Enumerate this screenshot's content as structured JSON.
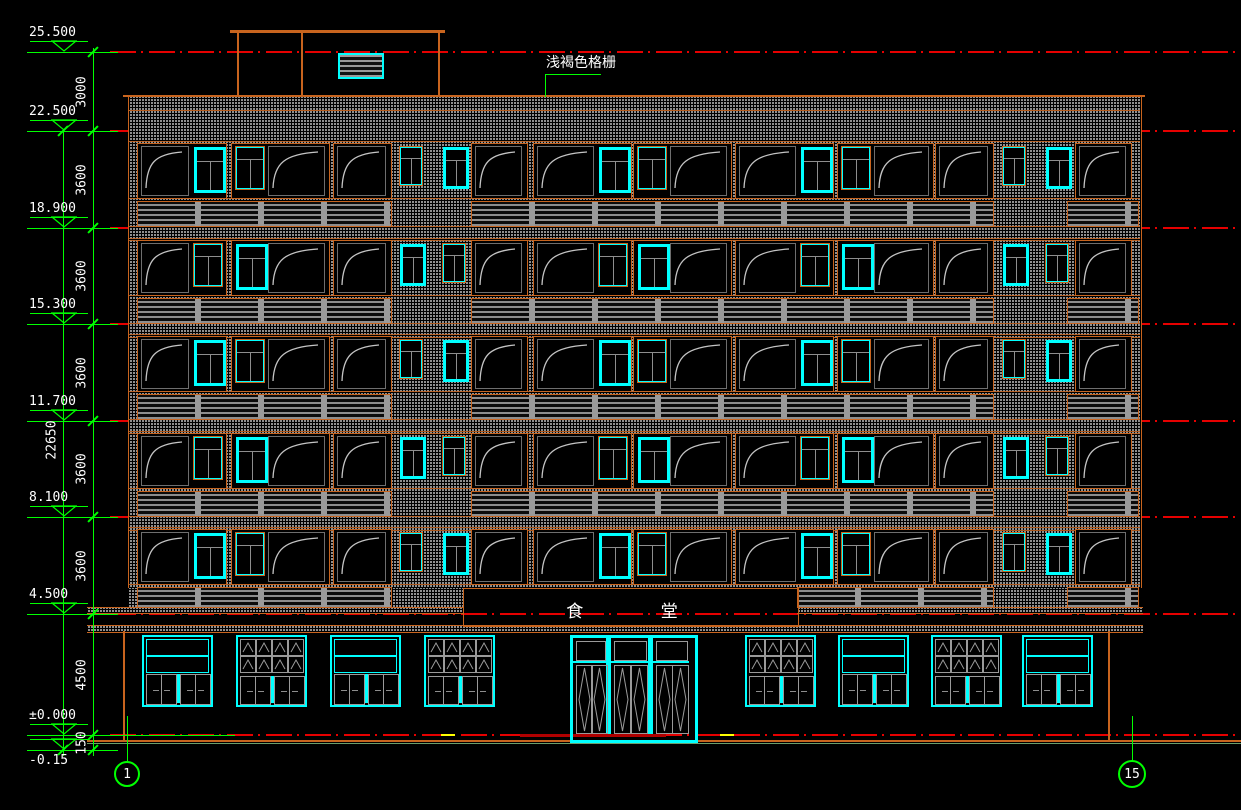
{
  "annotation": {
    "text": "浅褐色格栅"
  },
  "sign": {
    "text": "食 堂"
  },
  "elevations": {
    "labels": [
      "25.500",
      "22.500",
      "18.900",
      "15.300",
      "11.700",
      "8.100",
      "4.500",
      "±0.000",
      "-0.15"
    ]
  },
  "dims": {
    "chain": [
      "3000",
      "3600",
      "3600",
      "3600",
      "3600",
      "3600",
      "4500",
      "150"
    ],
    "overall": "22650"
  },
  "axis_bubbles": {
    "left": "1",
    "right": "15"
  },
  "colors": {
    "green": "#00ff00",
    "red": "#e60000",
    "orange": "#c8641e",
    "cyan": "#00ffff",
    "frame_gray": "#9a9a9a",
    "hatch_gray": "#8f8f8f",
    "white": "#ffffff",
    "yellow": "#ffff00",
    "pale_green": "#8fd48f",
    "dark_red": "#b00000",
    "swing_gray": "#c4c4c4"
  }
}
